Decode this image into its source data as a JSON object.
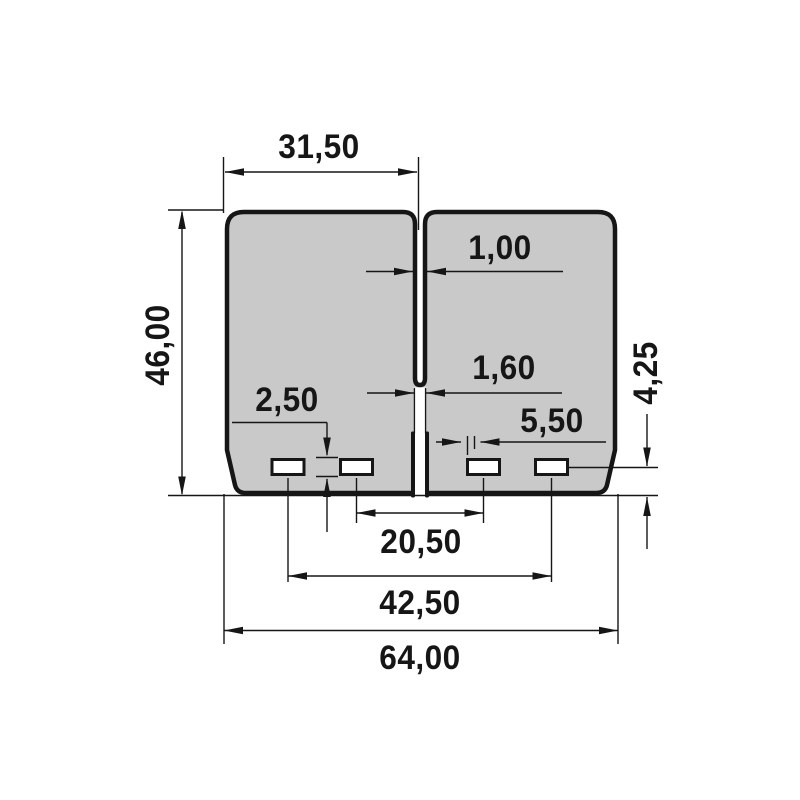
{
  "drawing": {
    "type": "technical-dimension-drawing",
    "part": "dual reed petal pair with center slit, bottom notch and four mounting slots",
    "units_style": "comma-decimal"
  },
  "dimensions": {
    "petal_width": {
      "label": "31,50",
      "mm": 31.5
    },
    "petal_height": {
      "label": "46,00",
      "mm": 46.0
    },
    "slit_width": {
      "label": "1,00",
      "mm": 1.0
    },
    "bottom_gap": {
      "label": "1,60",
      "mm": 1.6
    },
    "slot_height": {
      "label": "2,50",
      "mm": 2.5
    },
    "slot_width": {
      "label": "5,50",
      "mm": 5.5
    },
    "inner_slots_span": {
      "label": "20,50",
      "mm": 20.5
    },
    "outer_slots_span": {
      "label": "42,50",
      "mm": 42.5
    },
    "overall_width": {
      "label": "64,00",
      "mm": 64.0
    },
    "slots_to_bottom": {
      "label": "4,25",
      "mm": 4.25
    }
  },
  "colors": {
    "background": "#ffffff",
    "petal_fill": "#c9c9c9",
    "line": "#161616"
  }
}
